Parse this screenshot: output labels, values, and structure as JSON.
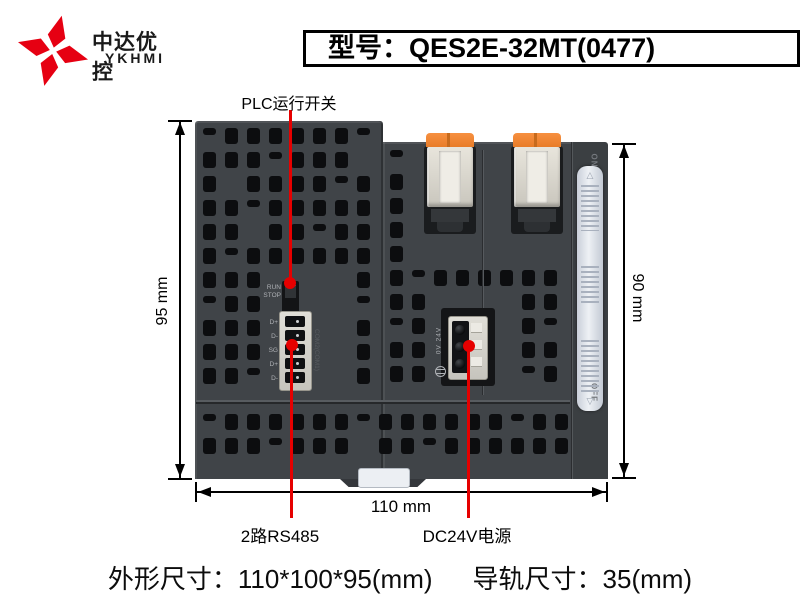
{
  "brand": {
    "name_cn": "中达优控",
    "name_en": "YKHMI",
    "logo_color": "#e60012"
  },
  "title": {
    "text": "型号：QES2E-32MT(0477)"
  },
  "annotations": {
    "run_switch": "PLC运行开关",
    "rs485": "2路RS485",
    "power": "DC24V电源",
    "line_color": "#e60000"
  },
  "dimensions": {
    "left": "95 mm",
    "right": "90 mm",
    "bottom": "110 mm"
  },
  "device": {
    "body_color": "#404448",
    "clip_orange": "#f0863a",
    "clip_cream": "#dedbd2",
    "slider_color": "#e2e6ec",
    "run_label": "RUN",
    "stop_label": "STOP",
    "on_label": "ON",
    "off_label": "OFF",
    "rs485_pins": [
      "D+",
      "D-",
      "SG",
      "D+",
      "D-"
    ],
    "rs485_side_label": "COM2(COM1)",
    "power_pins_label": "0V 24V"
  },
  "footer": {
    "outline": "外形尺寸：110*100*95(mm)",
    "rail": "导轨尺寸：35(mm)"
  }
}
